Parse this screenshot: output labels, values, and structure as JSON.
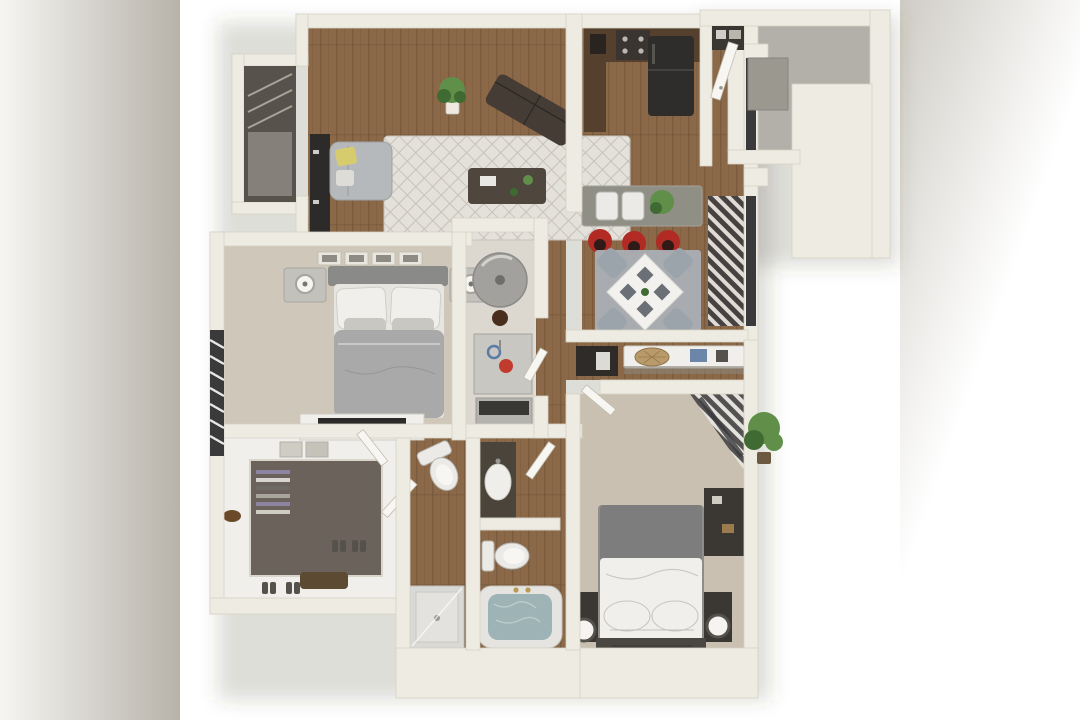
{
  "meta": {
    "title": "3D rendered floor plan of a two-bedroom, two-bathroom apartment with balcony",
    "canvas": {
      "width": 1080,
      "height": 720
    }
  },
  "palette": {
    "bg": "#ffffff",
    "bar_left_a": "#f6f5f2",
    "bar_left_b": "#b7b3aa",
    "bar_right_a": "#cfccc5",
    "bar_right_b": "#ffffff",
    "wall": "#edebe2",
    "wall_edge": "#d6d2c4",
    "wall_shadow": "#c2bdae",
    "shadow": "rgba(70,64,52,0.18)",
    "wood": "#8a6848",
    "wood_line": "#6a4d33",
    "carpet": "#cfc7b9",
    "carpet2": "#c9c0b2",
    "utility_floor": "#dcd8d0",
    "closet_floor": "#6b635b",
    "closet_dark": "#57534c",
    "rug_living": "#e4e1db",
    "rug_living_line": "#c7c3bb",
    "rug_dining": "#aab0b6",
    "concrete": "#b2b0a8",
    "storage_door": "#9a988f",
    "sofa_gray": "#b6b9bb",
    "sofa_dark": "#443c35",
    "pillow_yellow": "#d6cc6e",
    "table_dark": "#4f463e",
    "cabinet": "#54402c",
    "fridge": "#2e2d2c",
    "counter": "#8f8f86",
    "stool_red": "#b22a24",
    "stool_dark": "#301a18",
    "table_white": "#f2f1ee",
    "chair_gray": "#9ba3ab",
    "plate_gray": "#6b7077",
    "bed_duvet": "#a9a9a9",
    "blanket_dark": "#7d7d7d",
    "bed_white": "#f0efec",
    "headboard": "#8a8a88",
    "headboard_dark": "#4a4742",
    "nightstand": "#c2c1bc",
    "nightstand_dark": "#3b3733",
    "lamp_white": "#f5f4f1",
    "art_frame": "#e8e6df",
    "blind_dark": "#3e3e40",
    "blind_light": "#e9e8e4",
    "window_glass": "#3a3a3c",
    "door": "#f7f6f3",
    "water_heater": "#a2a19e",
    "hookup_red": "#c03b2e",
    "hookup_blue": "#5a7ba6",
    "appliance_gray": "#c9c7c1",
    "toilet": "#eceae7",
    "fixture_shadow": "#b9b7b2",
    "vanity": "#4a443b",
    "tub_rim": "#e5e4e0",
    "tub_water": "#9eb3b5",
    "shower": "#d9d9d5",
    "plant": "#5f8f49",
    "plant_dark": "#3f6b33",
    "pot": "#efe9e0",
    "basket_tan": "#b99a6a",
    "box_blue": "#6b86a8",
    "console_dark": "#2f2b28",
    "media_dark": "#2c2b29",
    "faucet_gold": "#b89a55"
  },
  "scene": {
    "letterbox": {
      "left_bar": "blurred-gray-gradient",
      "right_bar": "blurred-gray-gradient"
    },
    "rooms": [
      {
        "name": "living-room",
        "floor": "hardwood",
        "furniture": [
          "gray-loveseat",
          "yellow-accent-pillow",
          "patterned-area-rug",
          "dark-coffee-table",
          "angled-dark-sofa",
          "potted-plant",
          "media-console",
          "corner-closet-window"
        ]
      },
      {
        "name": "kitchen",
        "floor": "hardwood",
        "furniture": [
          "l-shaped-dark-cabinets",
          "range",
          "black-refrigerator",
          "breakfast-bar",
          "double-sink",
          "bar-plant"
        ]
      },
      {
        "name": "dining-area",
        "floor": "hardwood",
        "furniture": [
          "square-white-table",
          "gray-chairs-x4",
          "gray-rug",
          "red-bar-stools-x3",
          "window-blinds"
        ]
      },
      {
        "name": "entry-hall",
        "floor": "hardwood",
        "furniture": [
          "front-door",
          "coat-closet"
        ]
      },
      {
        "name": "balcony-patio",
        "floor": "concrete",
        "furniture": [
          "storage-closet",
          "outdoor-plant"
        ]
      },
      {
        "name": "master-bedroom",
        "floor": "carpet",
        "furniture": [
          "queen-bed-gray-duvet",
          "white-pillows",
          "nightstands-x2",
          "lamps-x2",
          "wall-art-frames-x4",
          "dresser-with-tv",
          "window-blinds"
        ]
      },
      {
        "name": "utility-closet",
        "floor": "vinyl",
        "furniture": [
          "water-heater",
          "washer-dryer-hookup",
          "appliance"
        ]
      },
      {
        "name": "hallway",
        "floor": "hardwood",
        "furniture": [
          "console-shelf",
          "wicker-basket",
          "blue-storage-box",
          "linen-closet"
        ]
      },
      {
        "name": "bedroom-2",
        "floor": "carpet",
        "furniture": [
          "bed-white-duvet-gray-blanket",
          "dark-nightstands-x2",
          "round-lamps-x2",
          "dark-bookshelf",
          "corner-window-blinds"
        ]
      },
      {
        "name": "walk-in-closet",
        "floor": "dark-carpet",
        "furniture": [
          "wrap-around-shelving",
          "hanging-clothes",
          "shoe-rack",
          "storage-boxes",
          "basket"
        ]
      },
      {
        "name": "bathroom-1",
        "floor": "hardwood",
        "furniture": [
          "toilet",
          "shower-stall",
          "swing-door"
        ]
      },
      {
        "name": "bathroom-2",
        "floor": "hardwood",
        "furniture": [
          "dark-vanity-with-sink",
          "toilet",
          "filled-bathtub",
          "swing-door"
        ]
      }
    ]
  }
}
